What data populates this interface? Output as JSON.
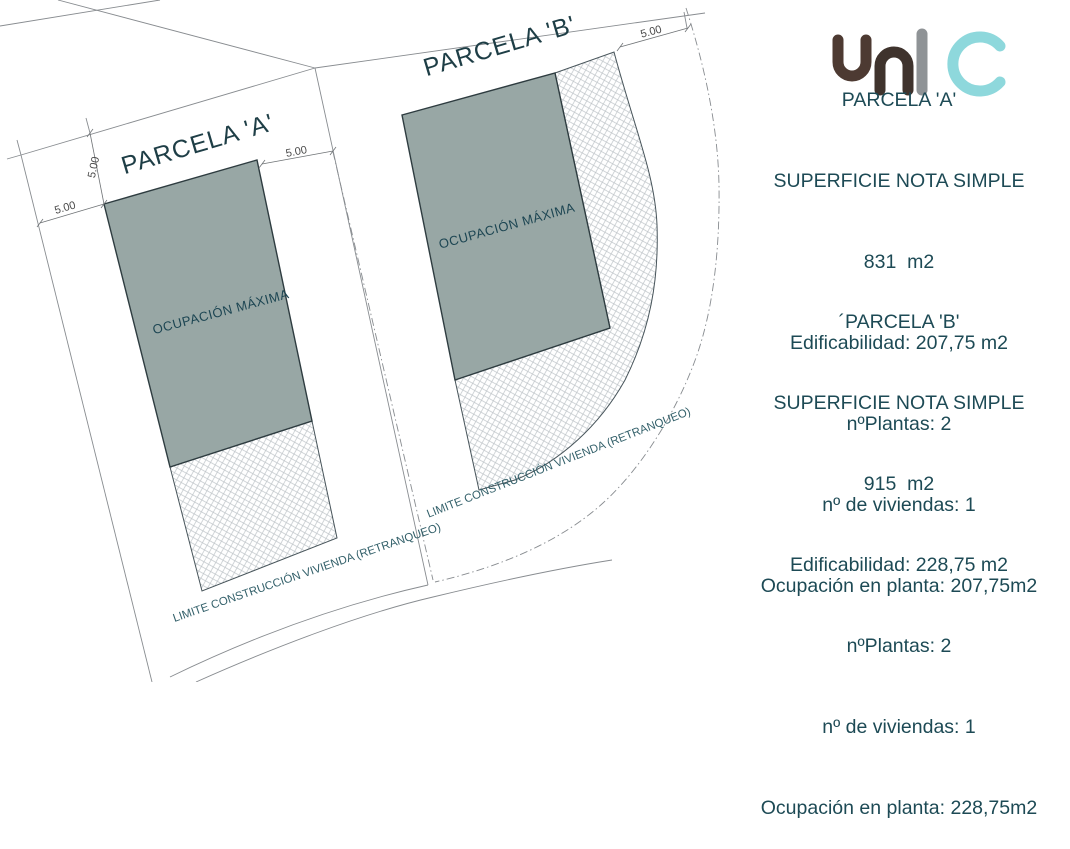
{
  "plan": {
    "parcel_a": {
      "title": "PARCELA 'A'",
      "occupation_label": "OCUPACIÓN MÁXIMA",
      "limit_label": "LIMITE CONSTRUCCIÓN VIVIENDA (RETRANQUEO)"
    },
    "parcel_b": {
      "title": "PARCELA 'B'",
      "occupation_label": "OCUPACIÓN MÁXIMA",
      "limit_label": "LIMITE CONSTRUCCIÓN VIVIENDA (RETRANQUEO)"
    },
    "dim_label": "5.00"
  },
  "info_a": {
    "lines": [
      "PARCELA 'A'",
      "SUPERFICIE NOTA SIMPLE",
      "831  m2",
      "Edificabilidad: 207,75 m2",
      "nºPlantas: 2",
      "nº de viviendas: 1",
      "Ocupación en planta: 207,75m2"
    ]
  },
  "info_b": {
    "lines": [
      "´PARCELA 'B'",
      "SUPERFICIE NOTA SIMPLE",
      "915  m2",
      "Edificabilidad: 228,75 m2",
      "nºPlantas: 2",
      "nº de viviendas: 1",
      "Ocupación en planta: 228,75m2"
    ]
  },
  "logo": {
    "name": "unic-logo",
    "colors": {
      "u": "#4d3a32",
      "n": "#3f332d",
      "i": "#8f9396",
      "c": "#8ed8dc"
    }
  },
  "colors": {
    "occupation_fill": "#98a7a5",
    "occupation_border": "#2e3c40",
    "hatch_line": "#bdc3c7",
    "hatch_border": "#47545a",
    "lot_line": "#888c90",
    "dim_text": "#4a4a4a",
    "title_text": "#1e3e46",
    "occupation_text": "#1d4653",
    "limit_text": "#33606a",
    "info_text": "#1d4a55"
  }
}
